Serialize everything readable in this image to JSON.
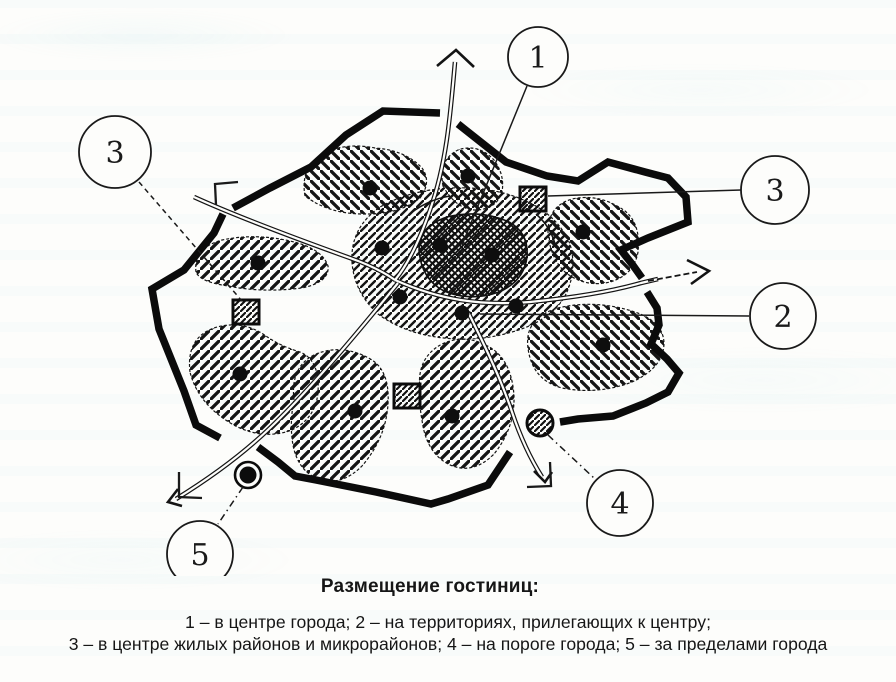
{
  "caption": {
    "title": "Размещение гостиниц:",
    "lines": [
      "1 – в центре города; 2 – на территориях, прилегающих к центру;",
      "3 – в центре жилых районов и микрорайонов; 4 – на пороге города; 5 – за пределами города"
    ]
  },
  "legend": [
    {
      "num": "1",
      "text": "в центре города"
    },
    {
      "num": "2",
      "text": "на территориях, прилегающих к центру"
    },
    {
      "num": "3",
      "text": "в центре жилых районов и микрорайонов"
    },
    {
      "num": "4",
      "text": "на пороге города"
    },
    {
      "num": "5",
      "text": "за пределами города"
    }
  ],
  "callouts": [
    {
      "label": "1"
    },
    {
      "label": "3"
    },
    {
      "label": "3"
    },
    {
      "label": "2"
    },
    {
      "label": "4"
    },
    {
      "label": "5"
    }
  ],
  "colors": {
    "ink": "#141414",
    "paper": "#fdfdfb",
    "showthrough_tint": "#7ec8d7"
  }
}
